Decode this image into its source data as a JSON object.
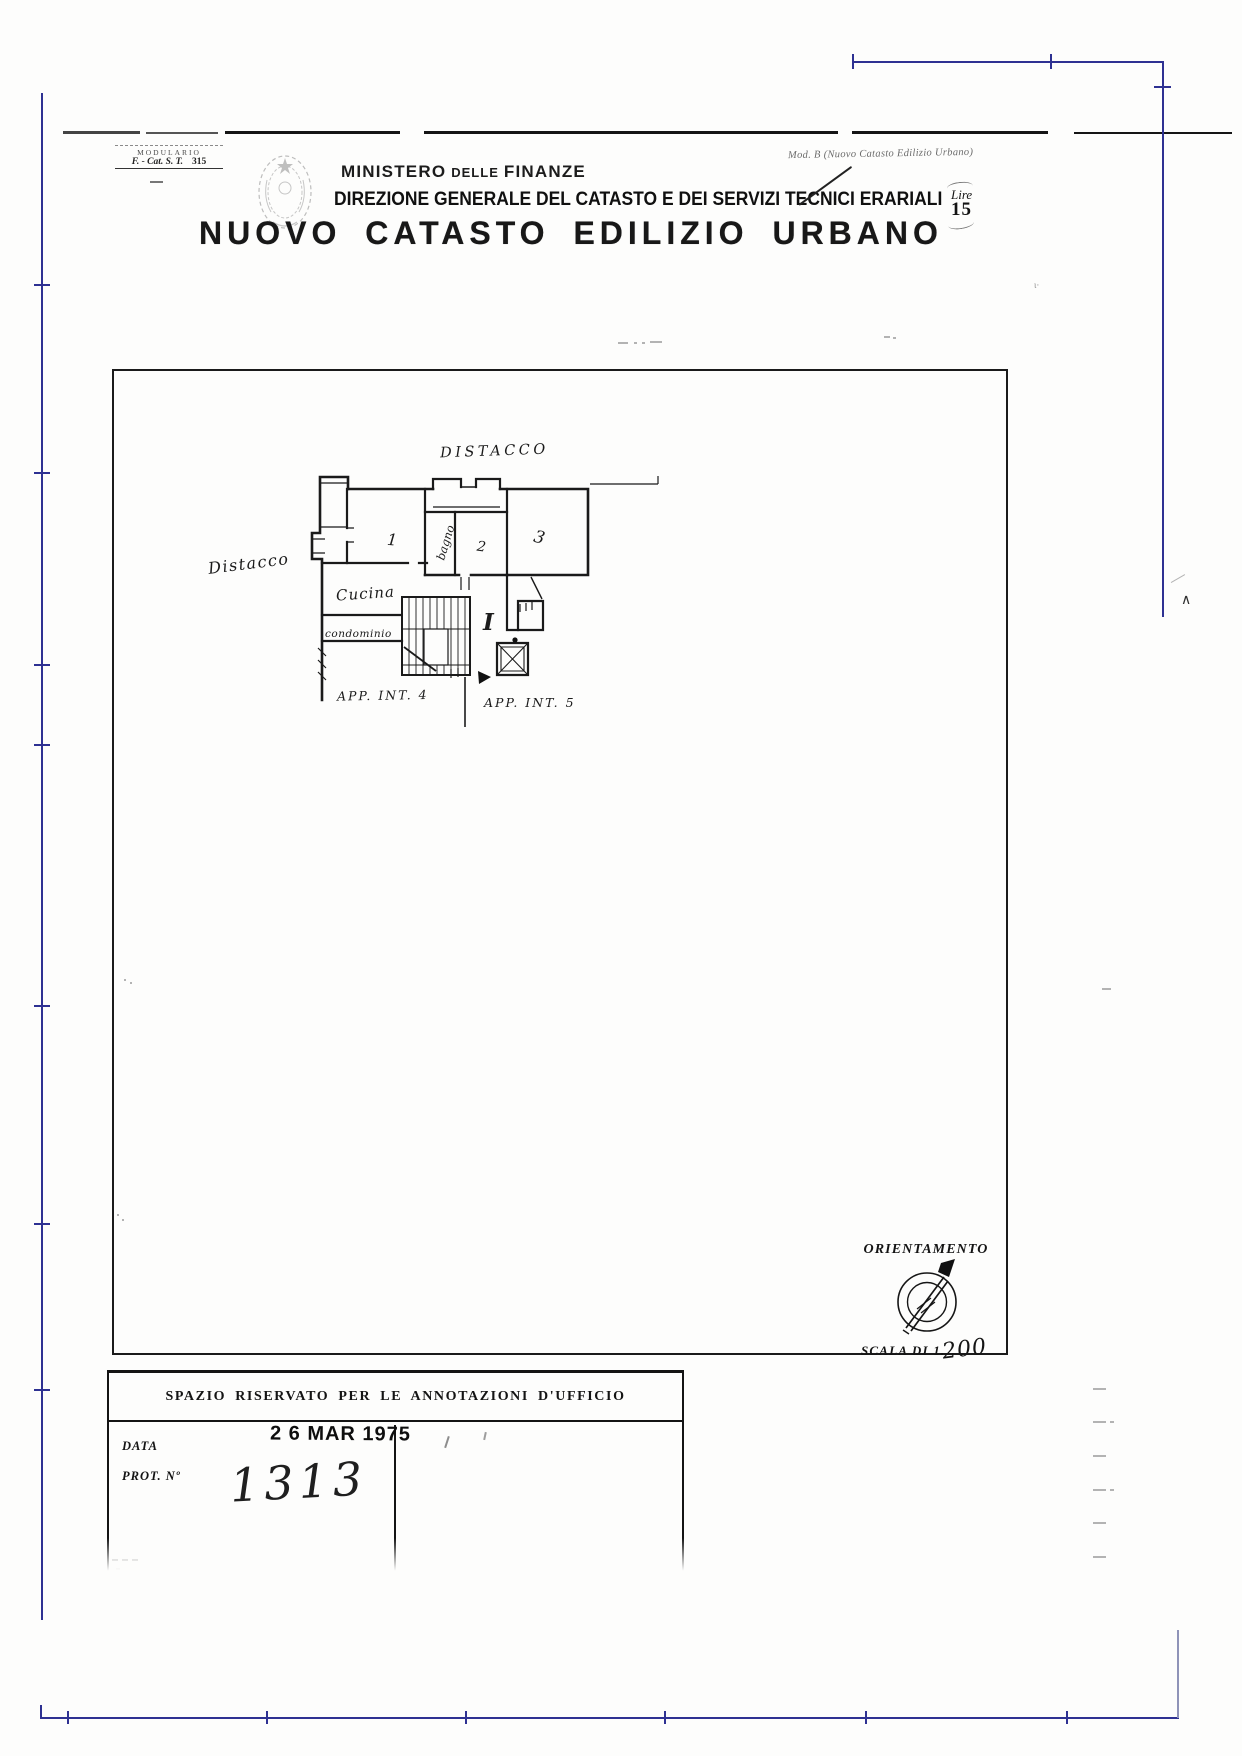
{
  "colors": {
    "frame_blue": "#2e3192",
    "ink": "#141414",
    "faint_gray": "#b3b3b3"
  },
  "corner_stamp": {
    "line1": "MODULARIO",
    "line2": "F. - Cat. S. T.",
    "number": "315"
  },
  "header": {
    "ministry_word1": "MINISTERO",
    "ministry_word2": "DELLE",
    "ministry_word3": "FINANZE",
    "direction": "DIREZIONE GENERALE DEL CATASTO E DEI SERVIZI TECNICI ERARIALI",
    "title": "NUOVO CATASTO EDILIZIO URBANO",
    "mod_note": "Mod. B (Nuovo Catasto Edilizio Urbano)",
    "fee_currency": "Lire",
    "fee_amount": "15"
  },
  "plan": {
    "labels": {
      "distacco_top": "DISTACCO",
      "distacco_left": "Distacco",
      "cucina": "Cucina",
      "condominio": "condominio",
      "bagno": "bagno",
      "room1": "1",
      "room2": "2",
      "room3": "3",
      "floor_numeral": "I",
      "app_int_4": "APP. INT. 4",
      "app_int_5": "APP. INT. 5"
    },
    "orientation_title": "ORIENTAMENTO",
    "scale_prefix": "SCALA DI 1.",
    "scale_value": "200"
  },
  "office_box": {
    "header": "SPAZIO RISERVATO PER LE ANNOTAZIONI D'UFFICIO",
    "date_label": "DATA",
    "prot_label": "PROT. Nº",
    "date_stamp": "2 6 MAR 1975",
    "prot_value": "1313"
  }
}
